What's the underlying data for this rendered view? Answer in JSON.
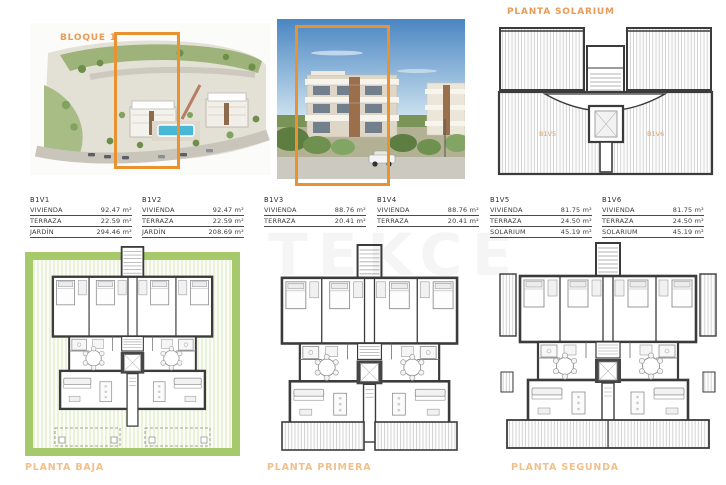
{
  "page": {
    "bloque_label": "BLOQUE 1",
    "solarium_title": "PLANTA SOLARIUM",
    "watermark": "TEKCE"
  },
  "solarium_plan": {
    "unit_left": "B1V5",
    "unit_right": "B1V6"
  },
  "units": [
    {
      "id": "B1V1",
      "rows": [
        {
          "label": "VIVIENDA",
          "value": "92.47 m²"
        },
        {
          "label": "TERRAZA",
          "value": "22.59 m²"
        },
        {
          "label": "JARDÍN",
          "value": "294.46 m²"
        }
      ]
    },
    {
      "id": "B1V2",
      "rows": [
        {
          "label": "VIVIENDA",
          "value": "92.47 m²"
        },
        {
          "label": "TERRAZA",
          "value": "22.59 m²"
        },
        {
          "label": "JARDÍN",
          "value": "208.69 m²"
        }
      ]
    },
    {
      "id": "B1V3",
      "rows": [
        {
          "label": "VIVIENDA",
          "value": "88.76 m²"
        },
        {
          "label": "TERRAZA",
          "value": "20.41 m²"
        }
      ]
    },
    {
      "id": "B1V4",
      "rows": [
        {
          "label": "VIVIENDA",
          "value": "88.76 m²"
        },
        {
          "label": "TERRAZA",
          "value": "20.41 m²"
        }
      ]
    },
    {
      "id": "B1V5",
      "rows": [
        {
          "label": "VIVIENDA",
          "value": "81.75 m²"
        },
        {
          "label": "TERRAZA",
          "value": "24.50 m²"
        },
        {
          "label": "SOLARIUM",
          "value": "45.19 m²"
        }
      ]
    },
    {
      "id": "B1V6",
      "rows": [
        {
          "label": "VIVIENDA",
          "value": "81.75 m²"
        },
        {
          "label": "TERRAZA",
          "value": "24.50 m²"
        },
        {
          "label": "SOLARIUM",
          "value": "45.19 m²"
        }
      ]
    }
  ],
  "plans": [
    {
      "label": "PLANTA BAJA"
    },
    {
      "label": "PLANTA PRIMERA"
    },
    {
      "label": "PLANTA SEGUNDA"
    }
  ],
  "colors": {
    "accent_orange": "#E8932F",
    "label_orange": "#E99B55",
    "plan_label_orange": "#F0C08C",
    "garden_green": "#A6C96B",
    "wall_dark": "#3B3B3B"
  }
}
